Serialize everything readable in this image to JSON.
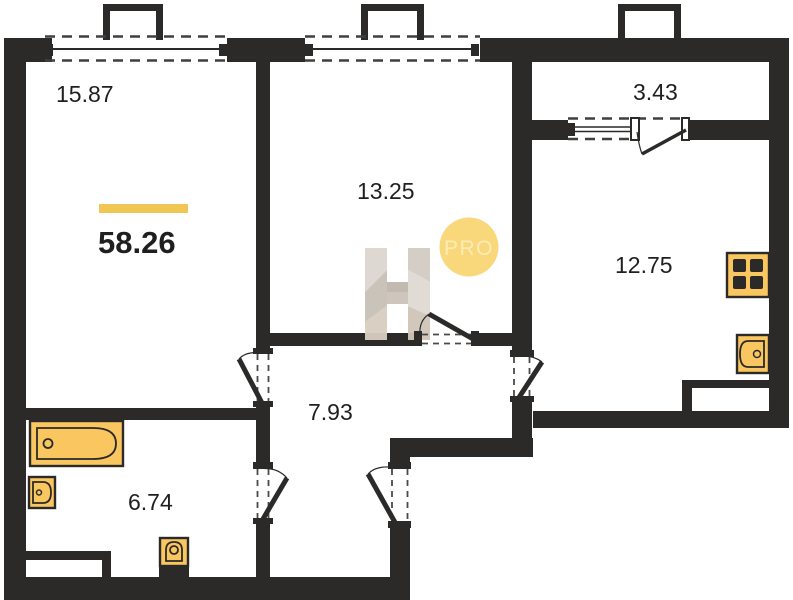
{
  "floor_plan": {
    "total_area": {
      "value": "58.26",
      "accent_color": "#F2C654"
    },
    "rooms": [
      {
        "name": "living-room",
        "area": "15.87"
      },
      {
        "name": "bedroom",
        "area": "13.25"
      },
      {
        "name": "balcony",
        "area": "3.43"
      },
      {
        "name": "kitchen",
        "area": "12.75"
      },
      {
        "name": "hallway",
        "area": "7.93"
      },
      {
        "name": "bathroom",
        "area": "6.74"
      }
    ],
    "fixtures": [
      "bathtub",
      "bathroom-sink",
      "toilet",
      "stove",
      "kitchen-sink"
    ],
    "watermark": {
      "letter": "H",
      "badge": "PRO"
    },
    "colors": {
      "wall": "#2B2A29",
      "fixture_fill": "#F9C65F",
      "accent_bar": "#F2C654",
      "watermark_grey": "#D5CFC8",
      "badge_fill": "#F8D87A",
      "label_text": "#1F1F1F"
    }
  }
}
